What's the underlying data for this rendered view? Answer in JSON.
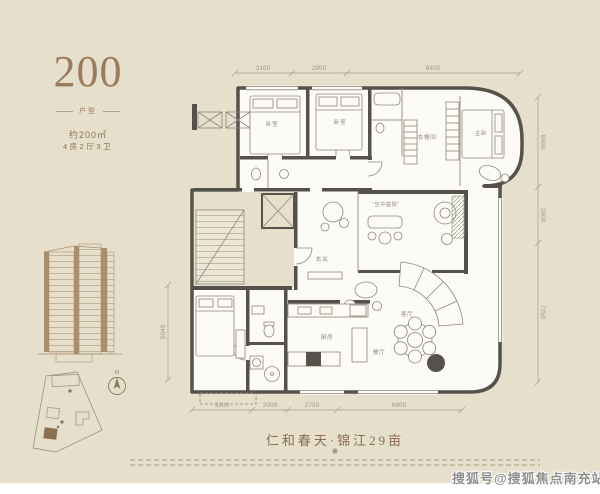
{
  "unit": {
    "number": "200",
    "type_label": "户型",
    "area_text": "约200㎡",
    "layout_text": "4房2厅3卫"
  },
  "plan": {
    "dims": {
      "top": [
        "3100",
        "2950",
        "8400"
      ],
      "right": [
        "8400",
        "2600",
        "7250"
      ],
      "left": [
        "5040"
      ],
      "bottom": [
        "3300",
        "2000",
        "2750",
        "6800"
      ]
    },
    "rooms": {
      "bedroom1": "卧室",
      "bedroom2": "卧室",
      "master_bedroom": "主卧",
      "closet": "衣帽间",
      "terrace": "“空中庭院”",
      "foyer": "玄关",
      "living": "客厅",
      "dining": "餐厅",
      "kitchen": "厨房"
    },
    "compass_label": "N"
  },
  "footer": {
    "project_title": "仁和春天·锦江29亩",
    "ornament_icon": "❋"
  },
  "watermark": "搜狐号@搜狐焦点南充站",
  "colors": {
    "background": "#e6dfcc",
    "wall": "#55524b",
    "accent_brown": "#9a7b5c",
    "dim_text": "#a2987f",
    "watermark_gray": "#8f8f8f"
  }
}
